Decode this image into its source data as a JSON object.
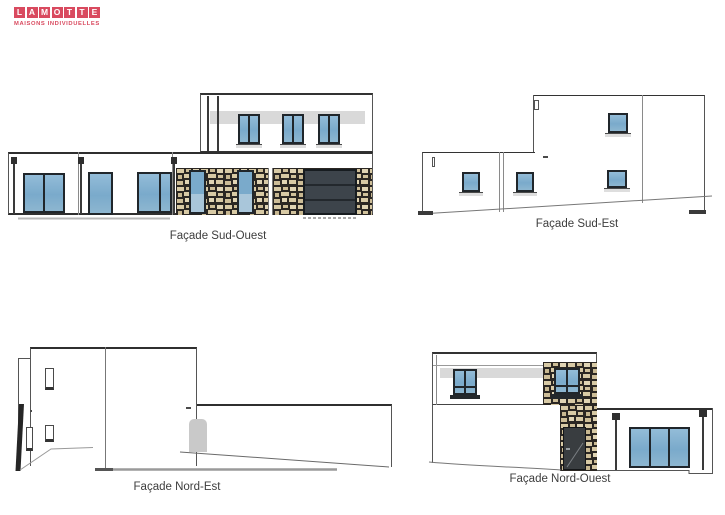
{
  "brand": {
    "letters": [
      "L",
      "A",
      "M",
      "O",
      "T",
      "T",
      "E"
    ],
    "subtitle": "MAISONS INDIVIDUELLES",
    "color": "#d94a5f"
  },
  "captions": {
    "sud_ouest": "Façade Sud-Ouest",
    "sud_est": "Façade Sud-Est",
    "nord_est": "Façade Nord-Est",
    "nord_ouest": "Façade Nord-Ouest"
  },
  "colors": {
    "drawing_line": "#3a3a3a",
    "window_frame": "#20262b",
    "window_glass": "#7aaacb",
    "window_glass_light": "#a9c6da",
    "stone_joint": "#2b2723",
    "stone_tan": "#d8caa5",
    "garage_door": "#3d444b",
    "entry_door": "#393d40",
    "door_silhouette": "#c9c9c9",
    "shadow_band": "#d9d9d9"
  }
}
